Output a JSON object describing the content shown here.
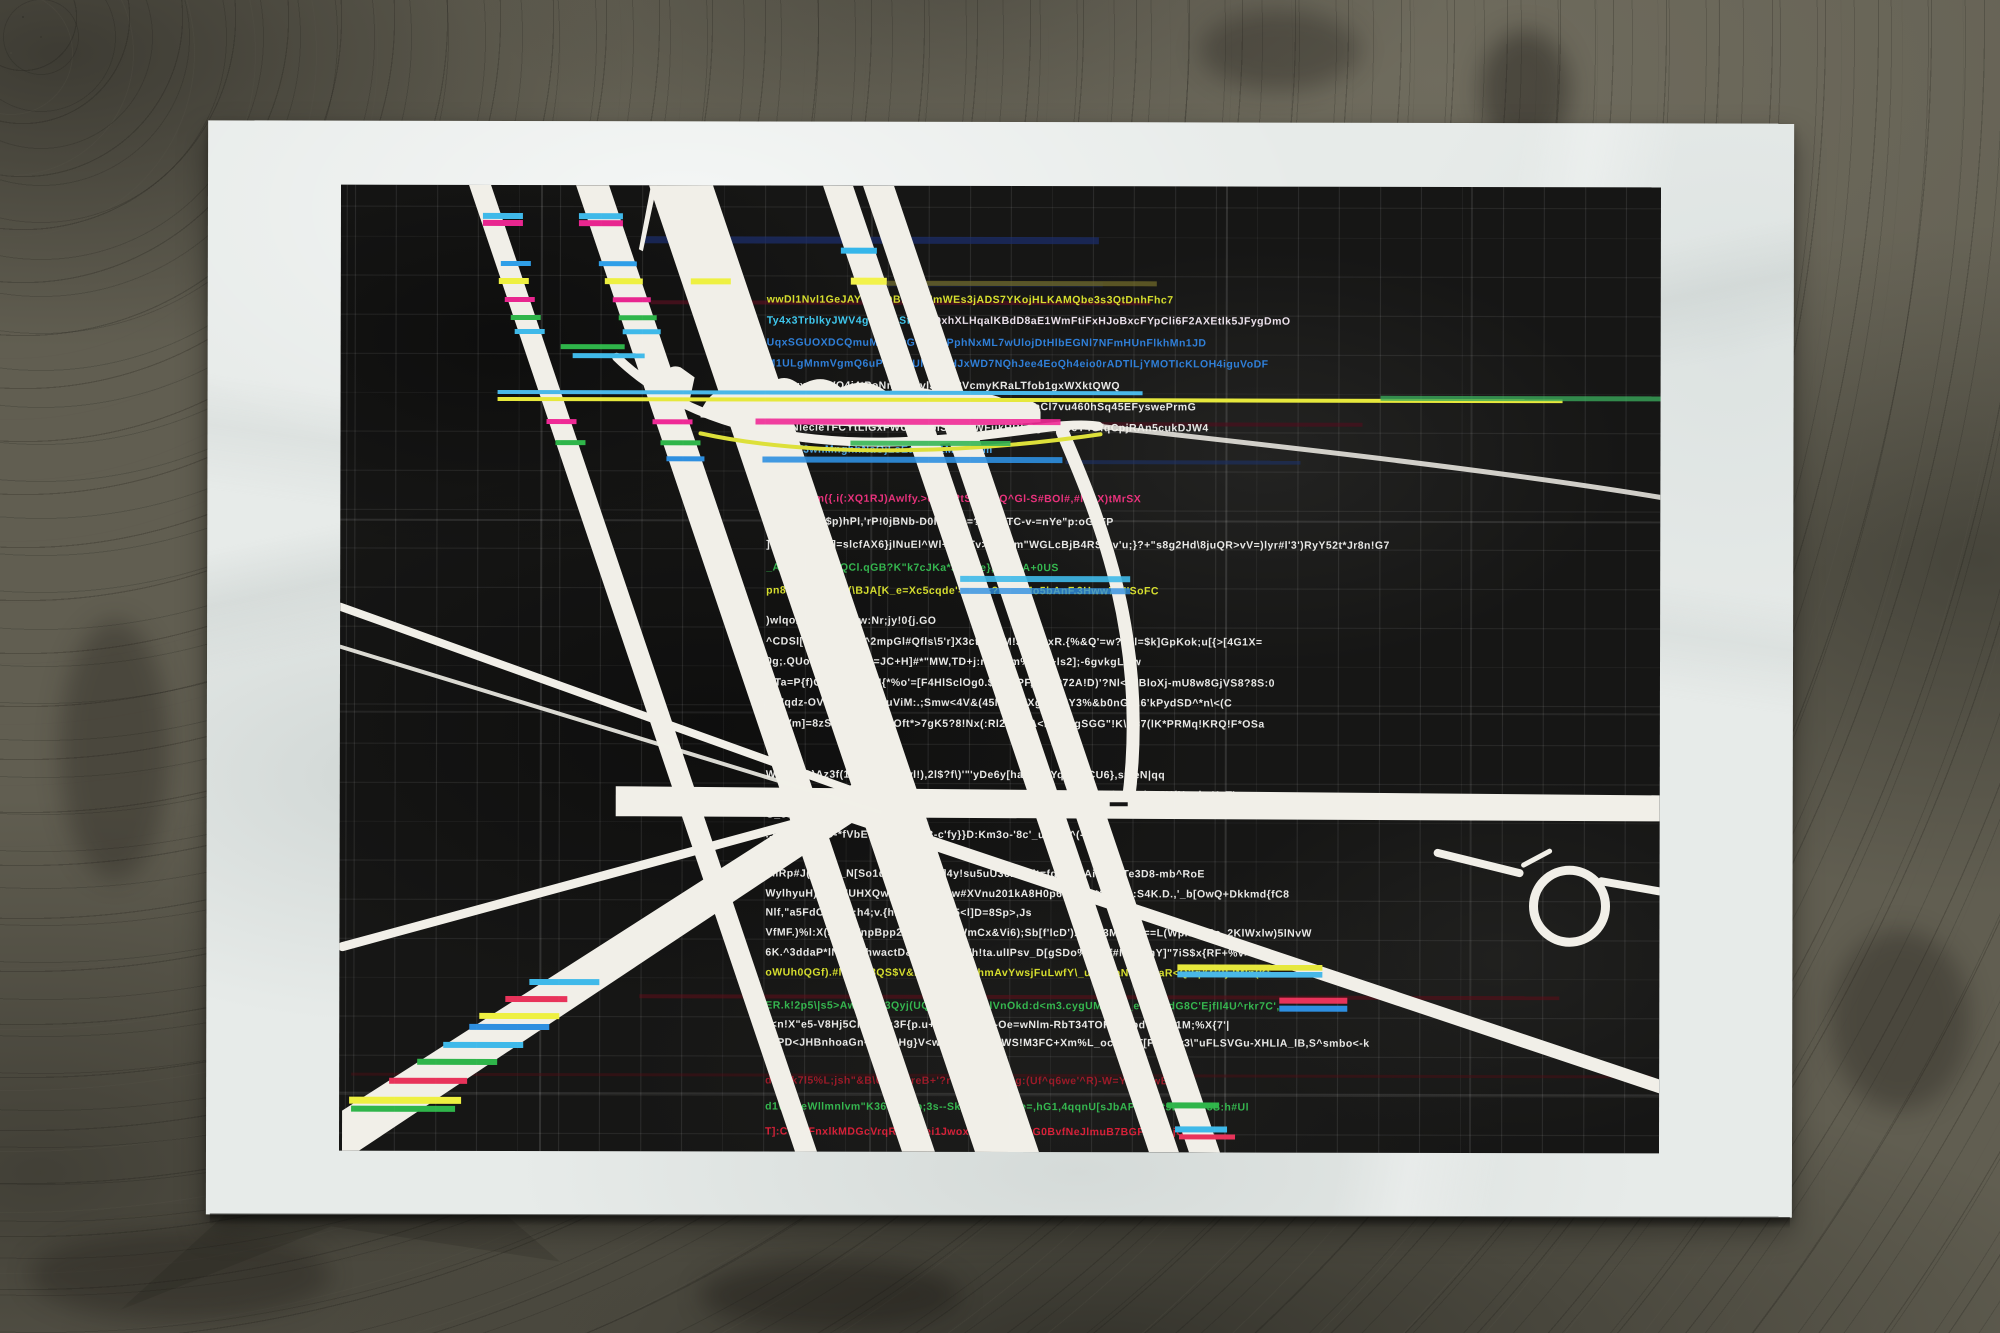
{
  "art": {
    "left": 426,
    "blocks": [
      {
        "top": 109,
        "lh": 21.4,
        "lines": [
          {
            "t": "wwDl1Nvl1GeJAYQO2DBfcEaNmWEs3jADS7YKojHLKAMQbe3s3QtDnhFhc7",
            "c": "#d6de2e"
          },
          {
            "t": "Ty4x3TrblkyJWV4g6v2rbSf60mQxhXLHqalKBdD8aE1WmFtiFxHJoBxcFYpCli6F2AXEtlk5JFygDmO",
            "c": "#3fc8ee",
            "c2": "#e9dfe9",
            "cut": 26
          },
          {
            "t": "UqxSGUOXDCQmuMKgrwGYlpbFPphNxML7wUlojDtHlbEGNl7NFmHUnFlkhMn1JD",
            "c": "#2f7fd8"
          },
          {
            "t": "M1ULgMnmVgmQ6uPLNK0Ulh233HJxWD7NQhJee4EoQh4eio0rADTlLjYMOTIcKLOH4iguVoDF",
            "c": "#2f7fd8"
          },
          {
            "t": "xBtvwx40FWQ4j4tPoNnbhv6vl3cxS3VcmyKRaLTfob1gxWXktQWQ",
            "c": "#e8e8e6"
          },
          {
            "t": "GcVrqRlcV0ieIT3WoxNkMo.ldq!3rG=Bv#pVB7BGFaCl7vu460hSq45EFyswePrmG",
            "c": "#e8e8e6"
          },
          {
            "t": "rLF2NlecleTFCYtLiGxFWUu5OolS2cis!WFukRBkQgUkBbeY4GfqCpjRAn5cukDJW4",
            "c": "#e8e8e6"
          },
          {
            "t": "MnHOf3wnMnghhNaOjLsEayjUc1Ms4CKm",
            "c": "#4fa8e8"
          }
        ]
      },
      {
        "top": 308,
        "lh": 23,
        "lines": [
          {
            "t": "U]&<PFl:m({.i(:XQ1RJ)Awlfy.>c0-|?2tSXtkmQ^Gl-S#BOl#,#lLpX)tMrSX",
            "c": "#e8327c"
          },
          {
            "t": "_:KxNqAR($p)hPl,'rP!0jBNb-D0l#DuG=?P#22TC-v-=nYe\"p:oG\"FP",
            "c": "#e8e8e6"
          },
          {
            "t": "]-Dwl&0lo:x.]=slcfAX6}jINuEl^Wl+olmTv>n:bAm\"WGLcBjB4RS(3v'u;}?+\"s8g2Hd\\8juQR>vV=)lyr#l'3')RyY52t*Jr8n!G7",
            "c": "#e8e8e6"
          },
          {
            "t": "_A)fHNA(O([gQCl.qGB?K\"k7cJKa*JrIcOe},yokOA+0US",
            "c": "#35b64f"
          },
          {
            "t": "pn87):VhP)-\"J$(\\BJA[K_e=Xc5cqde'=gPys?kGWMo5bAnF.3Hww7)H'SoFC",
            "c": "#d6de2e"
          }
        ]
      },
      {
        "top": 430,
        "lh": 20.5,
        "lines": [
          {
            "t": ")wlqoAnwpWr3\"0w:Nr;jy!0{j.GO",
            "c": "#e8e8e6"
          },
          {
            "t": "^CDSl[EeD^uwc0f^2mpGl#Qfls\\5'r]X3ct1tV6M!J:M!OxR.{%&Q'=w?77l=$k]GpKok;u[{>[4G1X=",
            "c": "#e8e8e6"
          },
          {
            "t": "0g;.QUoWPMLf#?e0=JC+H]#*\"MW,TD+j:nw'1\"m%4Vv+ls2];-6gvkgLQw",
            "c": "#e8e8e6"
          },
          {
            "t": "GTa=P{f)CL=edWMl{J{*%o'=[F4HlSclOg0.$:D[qPF,:TN5t72A!D)'?Nl<A)BloXj-mU8w8GjVS8?8S:0",
            "c": "#e8e8e6"
          },
          {
            "t": "DX'qdz-OVOrv0GfEk]4uViM:.;Smw<4V&(45M6iF-'Xg&{B8Y3%&b0nG'y.6'kPydSD^*n\\<(C",
            "c": "#e8e8e6"
          },
          {
            "t": "(C^Vm]=8zSlHD%84P73Oft*>7gK5?8!Nx(:Rl2Tp,VA<D%44gSGG\"!K\\!l=7(lK*PRMq!KRQ!F*OSa",
            "c": "#e8e8e6"
          }
        ]
      },
      {
        "top": 584,
        "lh": 20,
        "lines": [
          {
            "t": "WB3#cG)Az3f(1Rr67,yll3Fwl!),2l$?f\\)'\"'yDe6y[hal[?5+Yq'_R5CU6},s='eN|qq",
            "c": "#e8e8e6"
          },
          {
            "t": "qPJ^V]mVb!Hc^jq)U'W=!GT<J[l]FeW^q]L'Ct'^fQ(x>O)v>-pln4'W\"lF{h=dt&JH(NaplmXxT'",
            "c": "#e8e8e6"
          },
          {
            "t": "G_8l-vb;",
            "c": "#e8e8e6"
          },
          {
            "t": ".,mHwp'n'qO-*fVbE:lPw8Ht1%B-c'fy}}D:Km3o-'8c'_upyfE^(-vg",
            "c": "#e8e8e6"
          }
        ]
      },
      {
        "top": 683,
        "lh": 19.7,
        "lines": [
          {
            "t": "mlRp#J(q.!zn'_N[So1dmvpELJkY]4y!su5uU36rA7dt=fg!MX2Ai0i=]^Te3D8-mb^RoE",
            "c": "#e8e8e6"
          },
          {
            "t": "WylhyuH)?Bsg'UHXQwlfAdu8S?7hw#XVnu201kA8H0p6<Tkv8*?A63e:S4K.D.,'_b[OwQ+Dkkmd{fC8",
            "c": "#e8e8e6"
          },
          {
            "t": "Nlf,\"a5FdOS0,u*:h4;v.{hP?>Dgtxa!l5<l]D=8Sp>,Js",
            "c": "#e8e8e6"
          },
          {
            "t": "VfMF.)%l:X(so1FTnpBpp2iB1DQ#E>WmCx&Vi6);Sb[f'lcD')XQQ;3MU;7n==L(Wpl3<_Pe_2KlWxlw)5lNvW",
            "c": "#e8e8e6"
          },
          {
            "t": "6K.^3ddaP*lNe4sl:hwactD&^kGrXWfWh!ta.ulIPsv_D[gSDo%%V{f#M[._FnY]\"7iS$x{RF+%v>",
            "c": "#e8e8e6"
          },
          {
            "t": "oWUh0QGf).#lHD]U8QS$V&E%#Ysl:lYBhmAvYwsjFuLwfY\\_u&SKaN.CMMaR<Q2q&G?}JMln(K\\",
            "c": "#d6de2e"
          }
        ]
      },
      {
        "top": 815,
        "lh": 18.5,
        "lines": [
          {
            "t": "ER.k!2p5\\|s5>Aw-_Y{43Qyj(UQrC6qVSsrKlVnOkd:d<m3.cygUM;-f0=_eFmT\"dG8C'Ejfll4U^rkr7C',",
            "c": "#35b64f"
          },
          {
            "t": "\"<n!X\"e5-V8Hj5ClN;ut^;3F{p.u+2ldDt:h=u+-Oe=wNlm-RbT34TOKLW[pdVR.)V1M;%X{7'|",
            "c": "#e8e8e6"
          },
          {
            "t": "U]PD<JHBnhoaGn^7-E(1Hg}V<wDK&7uk%PWS!M3FC+Xm%L_ocDhNT[P',[=1v3\\\"uFLSVGu-XHLlA_lB,S^smbo<-k",
            "c": "#e8e8e6"
          }
        ]
      },
      {
        "top": 890,
        "lh": 25.5,
        "lines": [
          {
            "t": "d:XUk7l5%L;jsh\"&B\\UVoP8reB+'?r\"yBNL2EAHg:(Uf^q6we'^R)-W=Y_,m#wBG:M",
            "c": "#9c1a28"
          },
          {
            "t": "d1W5xeWllmnlvm\"K36t'Y'\"4b;3s--Sky>^Ou(JtLje=,hG1,4qqnU[sJbAPlCSXt5BeeXL8S:h#Ul",
            "c": "#35b64f"
          },
          {
            "t": "T]:CV'o\\FnxlkMDGcVrqRlcVUlei1JwoxYhHoJdgj3rG0BvfNeJlmuB7BGFM0gejO",
            "c": "#d72038"
          }
        ]
      }
    ]
  },
  "palette": {
    "paper": "#e7ebe9",
    "ink_black": "#161615",
    "band_white": "#f1efe8",
    "glitch_cyan": "#3fb9e9",
    "glitch_magenta": "#e8268f",
    "glitch_yellow": "#eef041",
    "glitch_green": "#2fb54a",
    "glitch_blue": "#2e8fe0",
    "glitch_red": "#e8335a",
    "floor": "#615e51"
  }
}
